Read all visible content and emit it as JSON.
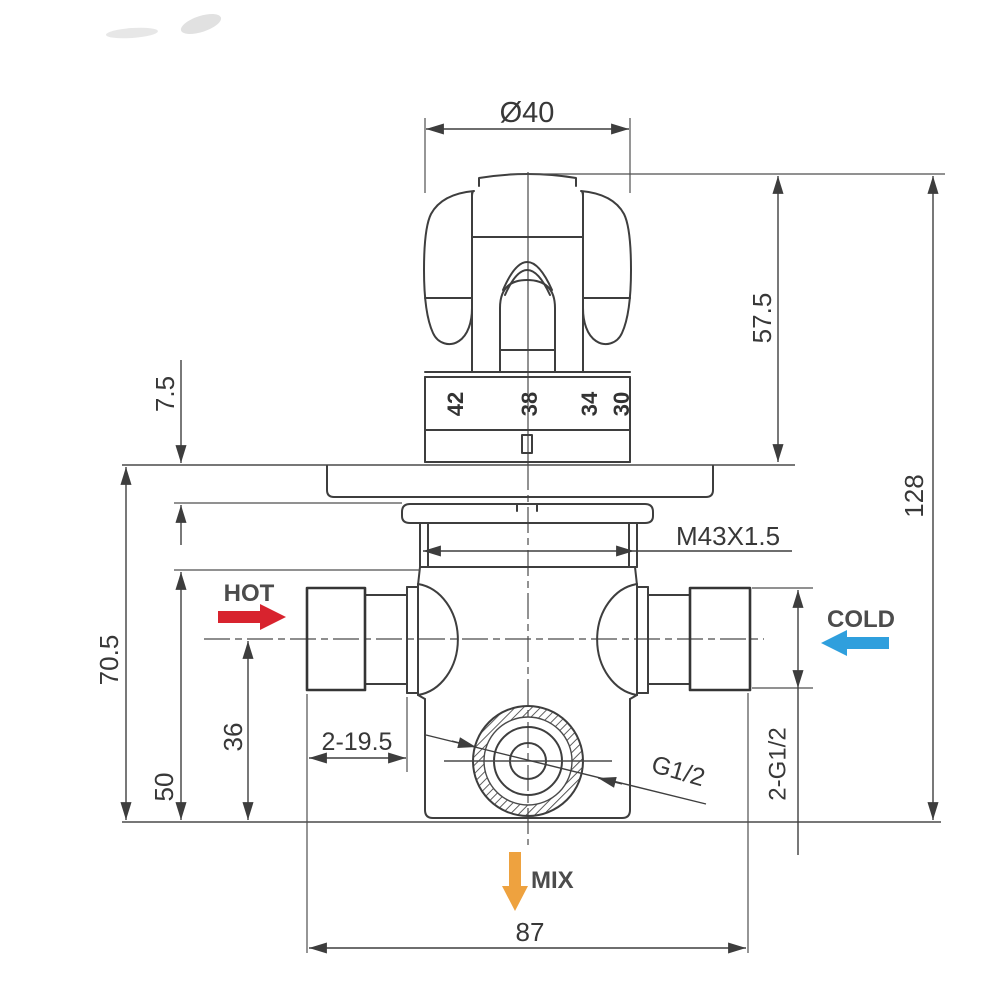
{
  "drawing": {
    "colors": {
      "hot_arrow": "#d8232e",
      "cold_arrow": "#2f9fdd",
      "mix_arrow": "#eea23f",
      "line": "#3e3e3e",
      "dim_text": "#383838"
    },
    "flow_labels": {
      "hot": "HOT",
      "cold": "COLD",
      "mix": "MIX"
    },
    "dims": {
      "knob_diameter": "Ø40",
      "handle_height": "57.5",
      "overall_height": "128",
      "plate_thickness": "7.5",
      "plate_to_base": "70.5",
      "body_depth": "50",
      "outlet_offset": "36",
      "escutcheon_thread": "M43X1.5",
      "inlet_depth": "2-19.5",
      "outlet_thread": "G1/2",
      "inlet_threads": "2-G1/2",
      "inlet_spacing": "87"
    },
    "temperature_scale": [
      "42",
      "38",
      "34",
      "30"
    ]
  }
}
